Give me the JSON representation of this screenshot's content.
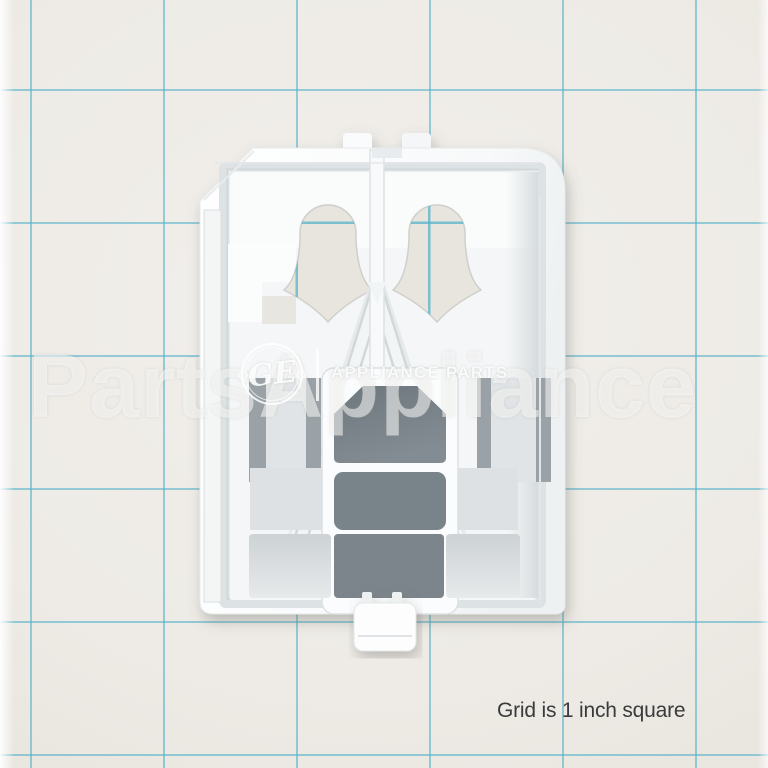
{
  "photo": {
    "subject": "white plastic appliance part on grid backdrop",
    "watermark": {
      "text": "PartsAppliance",
      "logo_monogram": "GE",
      "brand_label": "APPLIANCE PARTS"
    },
    "caption": {
      "text": "Grid is 1 inch square"
    },
    "colors": {
      "background": "#eeebe6",
      "grid_line": "#56b2c8",
      "part_white": "#ffffff",
      "opening_shadow": "#79838a",
      "frosted_panel": "#d3d8da",
      "caption_text": "#3a3b3c",
      "watermark_white": "rgba(255,255,255,0.52)"
    }
  }
}
